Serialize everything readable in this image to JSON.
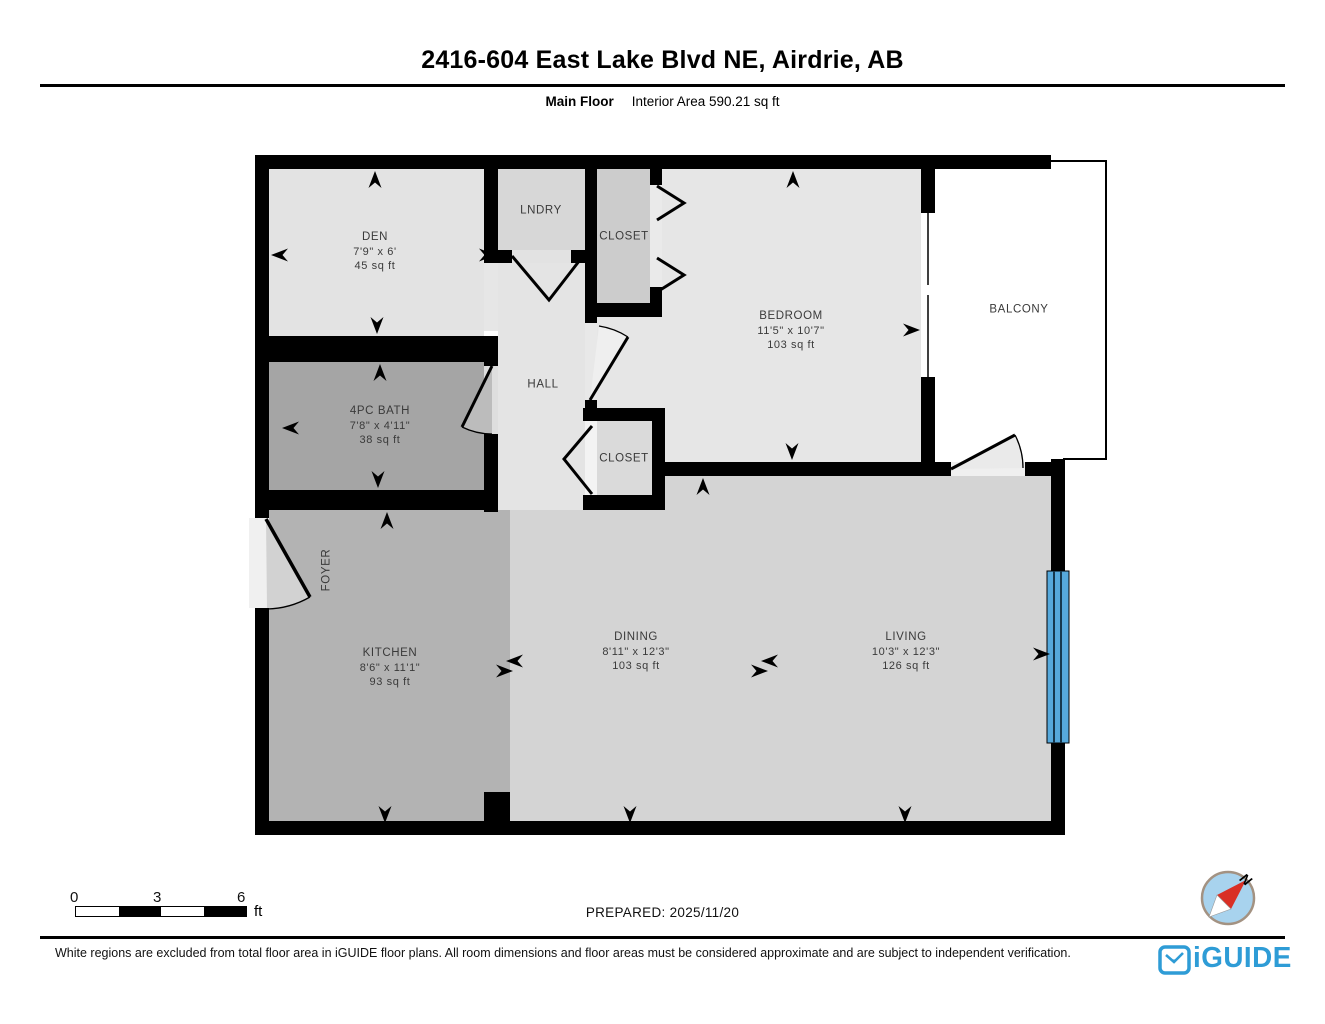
{
  "header": {
    "title": "2416-604 East Lake Blvd NE, Airdrie, AB",
    "floor_label": "Main Floor",
    "interior_area_label": "Interior Area 590.21 sq ft"
  },
  "rooms": {
    "den": {
      "name": "DEN",
      "dims": "7'9\" x 6'",
      "area": "45 sq ft"
    },
    "lndry": {
      "name": "LNDRY"
    },
    "closet_top": {
      "name": "CLOSET"
    },
    "bedroom": {
      "name": "BEDROOM",
      "dims": "11'5\" x 10'7\"",
      "area": "103 sq ft"
    },
    "balcony": {
      "name": "BALCONY"
    },
    "hall": {
      "name": "HALL"
    },
    "bath": {
      "name": "4PC BATH",
      "dims": "7'8\" x 4'11\"",
      "area": "38 sq ft"
    },
    "closet_bottom": {
      "name": "CLOSET"
    },
    "foyer": {
      "name": "FOYER"
    },
    "kitchen": {
      "name": "KITCHEN",
      "dims": "8'6\" x 11'1\"",
      "area": "93 sq ft"
    },
    "dining": {
      "name": "DINING",
      "dims": "8'11\" x 12'3\"",
      "area": "103 sq ft"
    },
    "living": {
      "name": "LIVING",
      "dims": "10'3\" x 12'3\"",
      "area": "126 sq ft"
    }
  },
  "scale_bar": {
    "ticks": [
      "0",
      "3",
      "6"
    ],
    "unit": "ft"
  },
  "compass": {
    "north_label": "N"
  },
  "footer": {
    "prepared": "PREPARED: 2025/11/20",
    "disclaimer": "White regions are excluded from total floor area in iGUIDE floor plans. All room dimensions and floor areas must be considered approximate and are subject to independent verification.",
    "brand": "iGUIDE"
  },
  "colors": {
    "window_blue": "#56a9dc",
    "brand_blue": "#2e9cd6",
    "wall_black": "#000000"
  }
}
